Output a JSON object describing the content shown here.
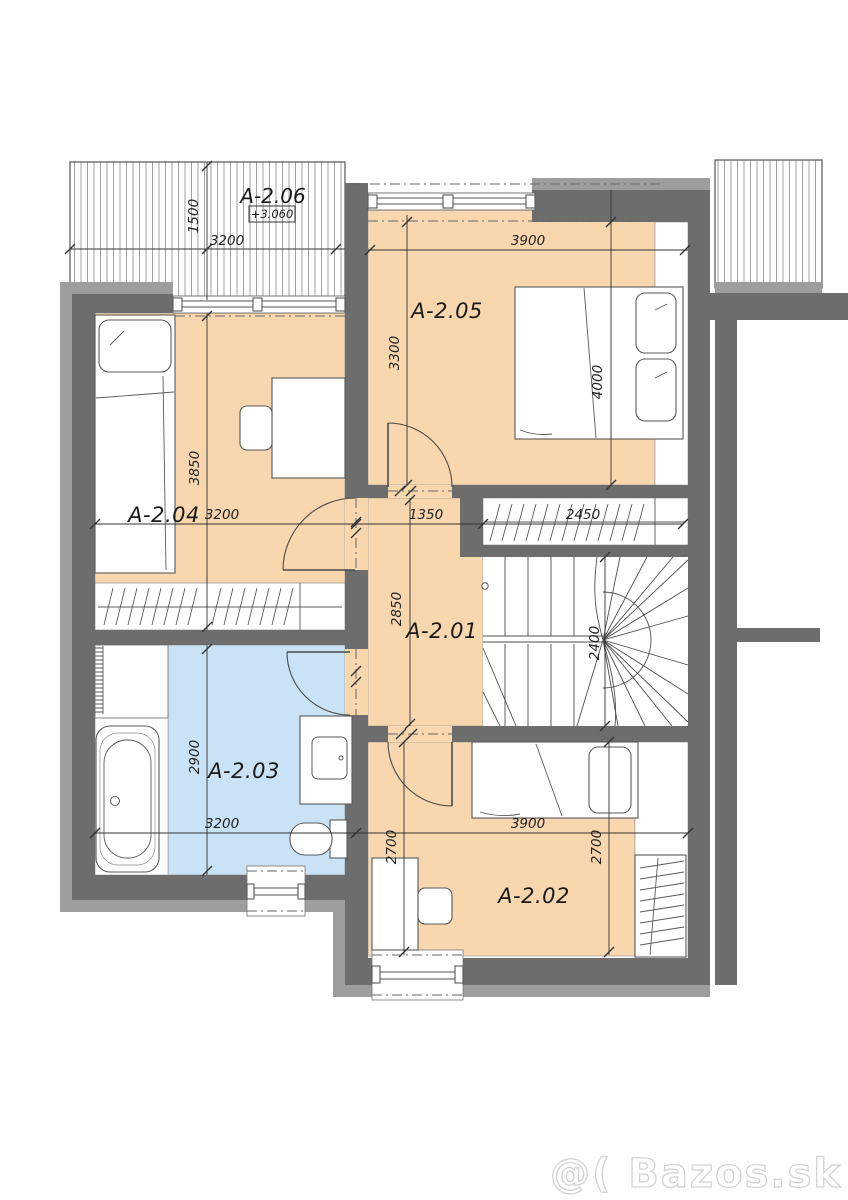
{
  "palette": {
    "floor_orange": "#f8d6ae",
    "floor_blue": "#cae2f5",
    "wall_dark": "#6d6d6d",
    "wall_light": "#9d9d9d",
    "line": "#4a4a4a",
    "watermark_gray": "#d3d3d3"
  },
  "watermark": "@( Bazos.sk",
  "rooms": {
    "a201": {
      "label": "A-2.01"
    },
    "a202": {
      "label": "A-2.02"
    },
    "a203": {
      "label": "A-2.03"
    },
    "a204": {
      "label": "A-2.04"
    },
    "a205": {
      "label": "A-2.05"
    },
    "a206": {
      "label": "A-2.06",
      "level": "+3.060"
    }
  },
  "dims": {
    "balcony_width": "3200",
    "balcony_depth": "1500",
    "a205_width": "3900",
    "a205_depth": "3300",
    "a205_length": "4000",
    "a204_width": "3200",
    "a204_depth": "3850",
    "hall_width": "1350",
    "hall_depth": "2850",
    "closet_width": "2450",
    "stair_run": "2400",
    "bath_width": "3200",
    "bath_depth": "2900",
    "a202_width": "3900",
    "a202_depth_left": "2700",
    "a202_depth_right": "2700"
  }
}
